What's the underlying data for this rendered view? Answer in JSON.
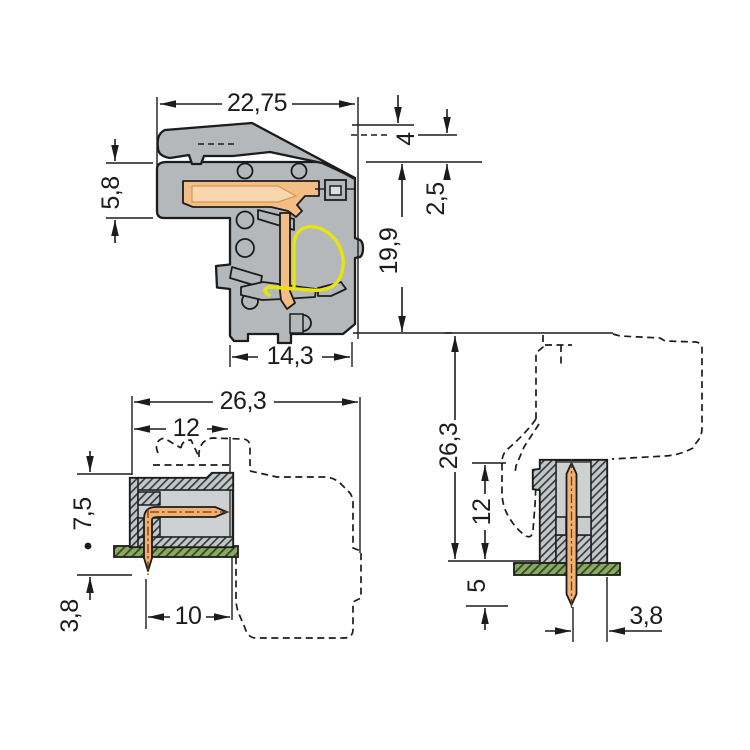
{
  "drawing": {
    "type": "connector-technical-dimension-drawing",
    "views": {
      "plug_section": {
        "dims": {
          "overall_width": "22,75",
          "nose_height": "5,8",
          "lever_rise": "4",
          "collar": "2,5",
          "body_height": "19,9",
          "lower_width": "14,3"
        }
      },
      "header_side": {
        "dims": {
          "overall_depth": "26,3",
          "housing_depth": "12",
          "height_above_board": "7,5",
          "pin_below_board": "3,8",
          "pin_length": "10"
        }
      },
      "header_front": {
        "dims": {
          "overall_height": "26,3",
          "housing_height": "12",
          "pin_protrusion": "5",
          "pin_to_edge": "3,8"
        }
      }
    },
    "colors": {
      "housing_gray": "#b4b8ba",
      "cavity_gray": "#ced1d2",
      "contact_orange": "#f4bd85",
      "pin_orange": "#f1b172",
      "spring_yellow": "#e8e40c",
      "pcb_green": "#8ba963",
      "line_black": "#1c1c1c"
    }
  }
}
